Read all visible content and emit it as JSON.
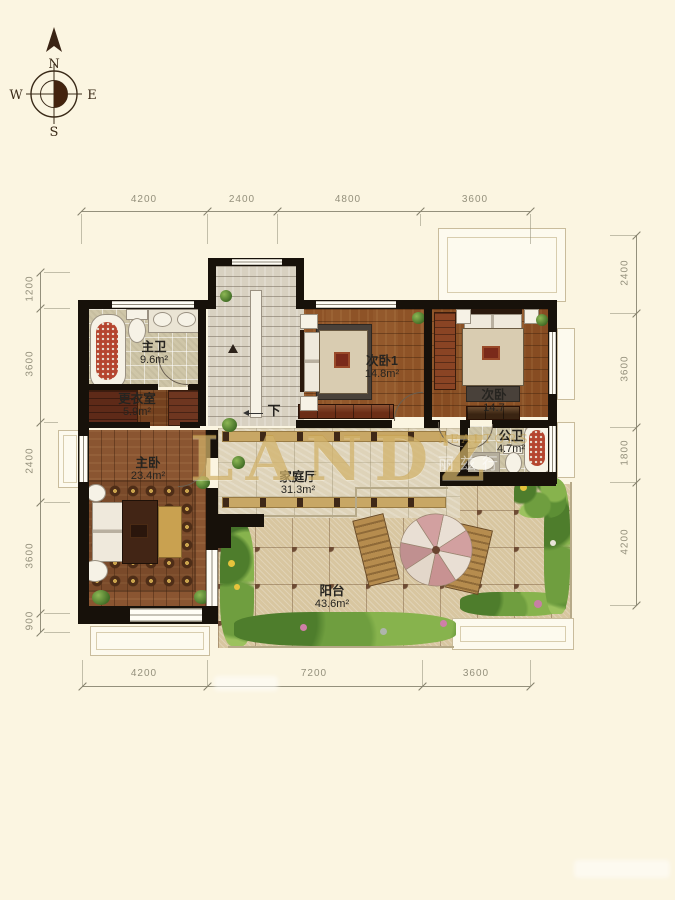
{
  "meta": {
    "background": "#FBF5E1",
    "wall_color": "#17110a",
    "gold_accent": "#C6A14A",
    "wood_color": "#8a5531",
    "paver_color": "#d8c6a0"
  },
  "compass": {
    "n": "N",
    "s": "S",
    "e": "E",
    "w": "W"
  },
  "dimensions": {
    "top": [
      "4200",
      "2400",
      "4800",
      "3600"
    ],
    "bottom": [
      "4200",
      "7200",
      "3600"
    ],
    "left": [
      "1200",
      "3600",
      "2400",
      "3600",
      "900"
    ],
    "right": [
      "2400",
      "3600",
      "1800",
      "4200"
    ]
  },
  "rooms": {
    "master_bath": {
      "name": "主卫",
      "area": "9.6m²"
    },
    "dressing": {
      "name": "更衣室",
      "area": "5.9m²"
    },
    "master_bed": {
      "name": "主卧",
      "area": "23.4m²"
    },
    "bedroom1": {
      "name": "次卧1",
      "area": "14.8m²"
    },
    "bedroom2": {
      "name": "次卧",
      "area": "14.7"
    },
    "guest_bath": {
      "name": "公卫",
      "area": "4.7m²"
    },
    "family_hall": {
      "name": "家庭厅",
      "area": "31.3m²"
    },
    "balcony": {
      "name": "阳台",
      "area": "43.6m²"
    }
  },
  "stairs": {
    "down_label": "下"
  },
  "watermark": {
    "brand": "LANDZ",
    "sub": "REALTORS",
    "sub_cn": "丽兹行"
  }
}
